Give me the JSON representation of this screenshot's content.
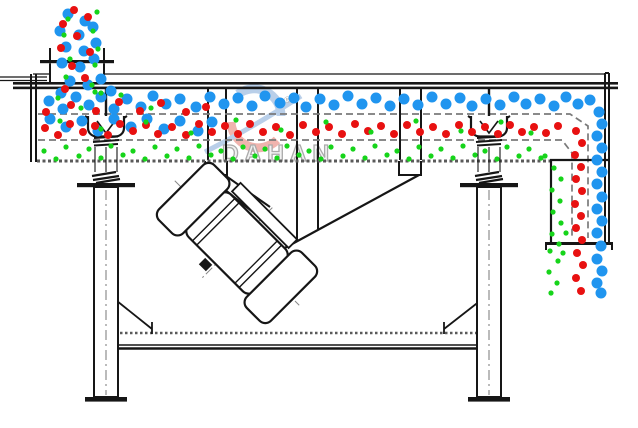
{
  "diagram": {
    "type": "linear-vibrating-screen-cross-section",
    "watermark": {
      "text": "DAHAN",
      "registered_mark": "®"
    },
    "colors": {
      "line": "#161616",
      "screen_dash": "#7a7a7a",
      "hatch_gray": "#5a5a5a",
      "watermark_blue": "#b9cfe9",
      "watermark_red": "#f0b4ae",
      "watermark_text": "#ababab"
    },
    "particles": {
      "blue": {
        "color": "#2095EF",
        "radius": 5.5,
        "points": [
          [
            68,
            14
          ],
          [
            85,
            21
          ],
          [
            60,
            31
          ],
          [
            79,
            35
          ],
          [
            93,
            27
          ],
          [
            66,
            47
          ],
          [
            84,
            51
          ],
          [
            96,
            43
          ],
          [
            62,
            63
          ],
          [
            80,
            67
          ],
          [
            94,
            59
          ],
          [
            70,
            81
          ],
          [
            88,
            85
          ],
          [
            61,
            93
          ],
          [
            101,
            79
          ],
          [
            111,
            91
          ],
          [
            49,
            101
          ],
          [
            63,
            109
          ],
          [
            76,
            97
          ],
          [
            89,
            105
          ],
          [
            101,
            97
          ],
          [
            114,
            109
          ],
          [
            127,
            99
          ],
          [
            141,
            107
          ],
          [
            153,
            96
          ],
          [
            166,
            104
          ],
          [
            50,
            119
          ],
          [
            66,
            127
          ],
          [
            82,
            121
          ],
          [
            98,
            131
          ],
          [
            114,
            119
          ],
          [
            131,
            127
          ],
          [
            147,
            119
          ],
          [
            164,
            129
          ],
          [
            180,
            121
          ],
          [
            198,
            131
          ],
          [
            212,
            122
          ],
          [
            180,
            99
          ],
          [
            196,
            107
          ],
          [
            210,
            97
          ],
          [
            224,
            104
          ],
          [
            238,
            98
          ],
          [
            252,
            106
          ],
          [
            265,
            96
          ],
          [
            280,
            103
          ],
          [
            294,
            98
          ],
          [
            306,
            107
          ],
          [
            320,
            99
          ],
          [
            334,
            105
          ],
          [
            348,
            96
          ],
          [
            362,
            104
          ],
          [
            376,
            98
          ],
          [
            390,
            106
          ],
          [
            404,
            99
          ],
          [
            418,
            105
          ],
          [
            432,
            97
          ],
          [
            446,
            104
          ],
          [
            460,
            98
          ],
          [
            472,
            106
          ],
          [
            486,
            99
          ],
          [
            500,
            105
          ],
          [
            514,
            97
          ],
          [
            526,
            104
          ],
          [
            540,
            99
          ],
          [
            554,
            106
          ],
          [
            566,
            97
          ],
          [
            578,
            104
          ],
          [
            590,
            100
          ],
          [
            599,
            112
          ],
          [
            602,
            124
          ],
          [
            597,
            136
          ],
          [
            602,
            148
          ],
          [
            597,
            160
          ],
          [
            602,
            172
          ],
          [
            597,
            184
          ],
          [
            602,
            197
          ],
          [
            597,
            209
          ],
          [
            602,
            221
          ],
          [
            597,
            233
          ],
          [
            601,
            246
          ],
          [
            597,
            259
          ],
          [
            602,
            271
          ],
          [
            597,
            283
          ],
          [
            601,
            293
          ]
        ]
      },
      "red": {
        "color": "#E81111",
        "radius": 4,
        "points": [
          [
            74,
            10
          ],
          [
            63,
            24
          ],
          [
            88,
            17
          ],
          [
            77,
            36
          ],
          [
            61,
            48
          ],
          [
            90,
            52
          ],
          [
            72,
            66
          ],
          [
            85,
            78
          ],
          [
            65,
            89
          ],
          [
            46,
            112
          ],
          [
            71,
            105
          ],
          [
            96,
            111
          ],
          [
            119,
            102
          ],
          [
            140,
            111
          ],
          [
            161,
            103
          ],
          [
            186,
            112
          ],
          [
            206,
            107
          ],
          [
            45,
            128
          ],
          [
            58,
            135
          ],
          [
            70,
            124
          ],
          [
            83,
            132
          ],
          [
            95,
            126
          ],
          [
            108,
            135
          ],
          [
            120,
            124
          ],
          [
            133,
            131
          ],
          [
            146,
            125
          ],
          [
            158,
            134
          ],
          [
            172,
            127
          ],
          [
            186,
            135
          ],
          [
            199,
            124
          ],
          [
            212,
            132
          ],
          [
            225,
            126
          ],
          [
            238,
            134
          ],
          [
            250,
            124
          ],
          [
            263,
            132
          ],
          [
            276,
            127
          ],
          [
            290,
            135
          ],
          [
            303,
            125
          ],
          [
            316,
            132
          ],
          [
            329,
            127
          ],
          [
            342,
            134
          ],
          [
            355,
            124
          ],
          [
            368,
            131
          ],
          [
            381,
            126
          ],
          [
            394,
            134
          ],
          [
            407,
            125
          ],
          [
            420,
            132
          ],
          [
            433,
            127
          ],
          [
            446,
            134
          ],
          [
            459,
            125
          ],
          [
            472,
            132
          ],
          [
            485,
            127
          ],
          [
            498,
            134
          ],
          [
            510,
            125
          ],
          [
            522,
            132
          ],
          [
            534,
            127
          ],
          [
            546,
            133
          ],
          [
            558,
            126
          ],
          [
            576,
            131
          ],
          [
            582,
            143
          ],
          [
            575,
            155
          ],
          [
            581,
            167
          ],
          [
            576,
            179
          ],
          [
            582,
            191
          ],
          [
            575,
            204
          ],
          [
            581,
            216
          ],
          [
            576,
            228
          ],
          [
            582,
            240
          ],
          [
            577,
            253
          ],
          [
            583,
            265
          ],
          [
            576,
            278
          ],
          [
            581,
            291
          ]
        ]
      },
      "green": {
        "color": "#16D41A",
        "radius": 2.6,
        "points": [
          [
            97,
            12
          ],
          [
            68,
            19
          ],
          [
            93,
            31
          ],
          [
            64,
            35
          ],
          [
            98,
            49
          ],
          [
            70,
            59
          ],
          [
            95,
            65
          ],
          [
            66,
            77
          ],
          [
            92,
            85
          ],
          [
            101,
            93
          ],
          [
            58,
            98
          ],
          [
            81,
            108
          ],
          [
            121,
            95
          ],
          [
            151,
            108
          ],
          [
            95,
            92
          ],
          [
            60,
            121
          ],
          [
            101,
            129
          ],
          [
            146,
            122
          ],
          [
            191,
            133
          ],
          [
            236,
            120
          ],
          [
            281,
            130
          ],
          [
            326,
            122
          ],
          [
            371,
            132
          ],
          [
            416,
            121
          ],
          [
            461,
            131
          ],
          [
            501,
            122
          ],
          [
            531,
            133
          ],
          [
            44,
            151
          ],
          [
            56,
            159
          ],
          [
            66,
            147
          ],
          [
            79,
            156
          ],
          [
            89,
            149
          ],
          [
            101,
            158
          ],
          [
            111,
            146
          ],
          [
            123,
            155
          ],
          [
            133,
            151
          ],
          [
            145,
            159
          ],
          [
            155,
            147
          ],
          [
            167,
            156
          ],
          [
            177,
            149
          ],
          [
            189,
            158
          ],
          [
            199,
            146
          ],
          [
            211,
            155
          ],
          [
            221,
            151
          ],
          [
            233,
            159
          ],
          [
            243,
            147
          ],
          [
            255,
            156
          ],
          [
            265,
            149
          ],
          [
            277,
            158
          ],
          [
            287,
            146
          ],
          [
            299,
            155
          ],
          [
            309,
            151
          ],
          [
            321,
            159
          ],
          [
            331,
            147
          ],
          [
            343,
            156
          ],
          [
            353,
            149
          ],
          [
            365,
            158
          ],
          [
            375,
            146
          ],
          [
            387,
            155
          ],
          [
            397,
            151
          ],
          [
            409,
            159
          ],
          [
            419,
            147
          ],
          [
            431,
            156
          ],
          [
            441,
            149
          ],
          [
            453,
            158
          ],
          [
            463,
            146
          ],
          [
            475,
            155
          ],
          [
            485,
            151
          ],
          [
            497,
            159
          ],
          [
            507,
            147
          ],
          [
            519,
            156
          ],
          [
            529,
            149
          ],
          [
            541,
            158
          ],
          [
            545,
            156
          ],
          [
            554,
            168
          ],
          [
            561,
            179
          ],
          [
            552,
            190
          ],
          [
            560,
            201
          ],
          [
            553,
            212
          ],
          [
            561,
            223
          ],
          [
            552,
            234
          ],
          [
            559,
            244
          ],
          [
            550,
            251
          ],
          [
            558,
            261
          ],
          [
            549,
            272
          ],
          [
            557,
            283
          ],
          [
            551,
            293
          ],
          [
            563,
            253
          ],
          [
            566,
            233
          ]
        ]
      }
    }
  }
}
